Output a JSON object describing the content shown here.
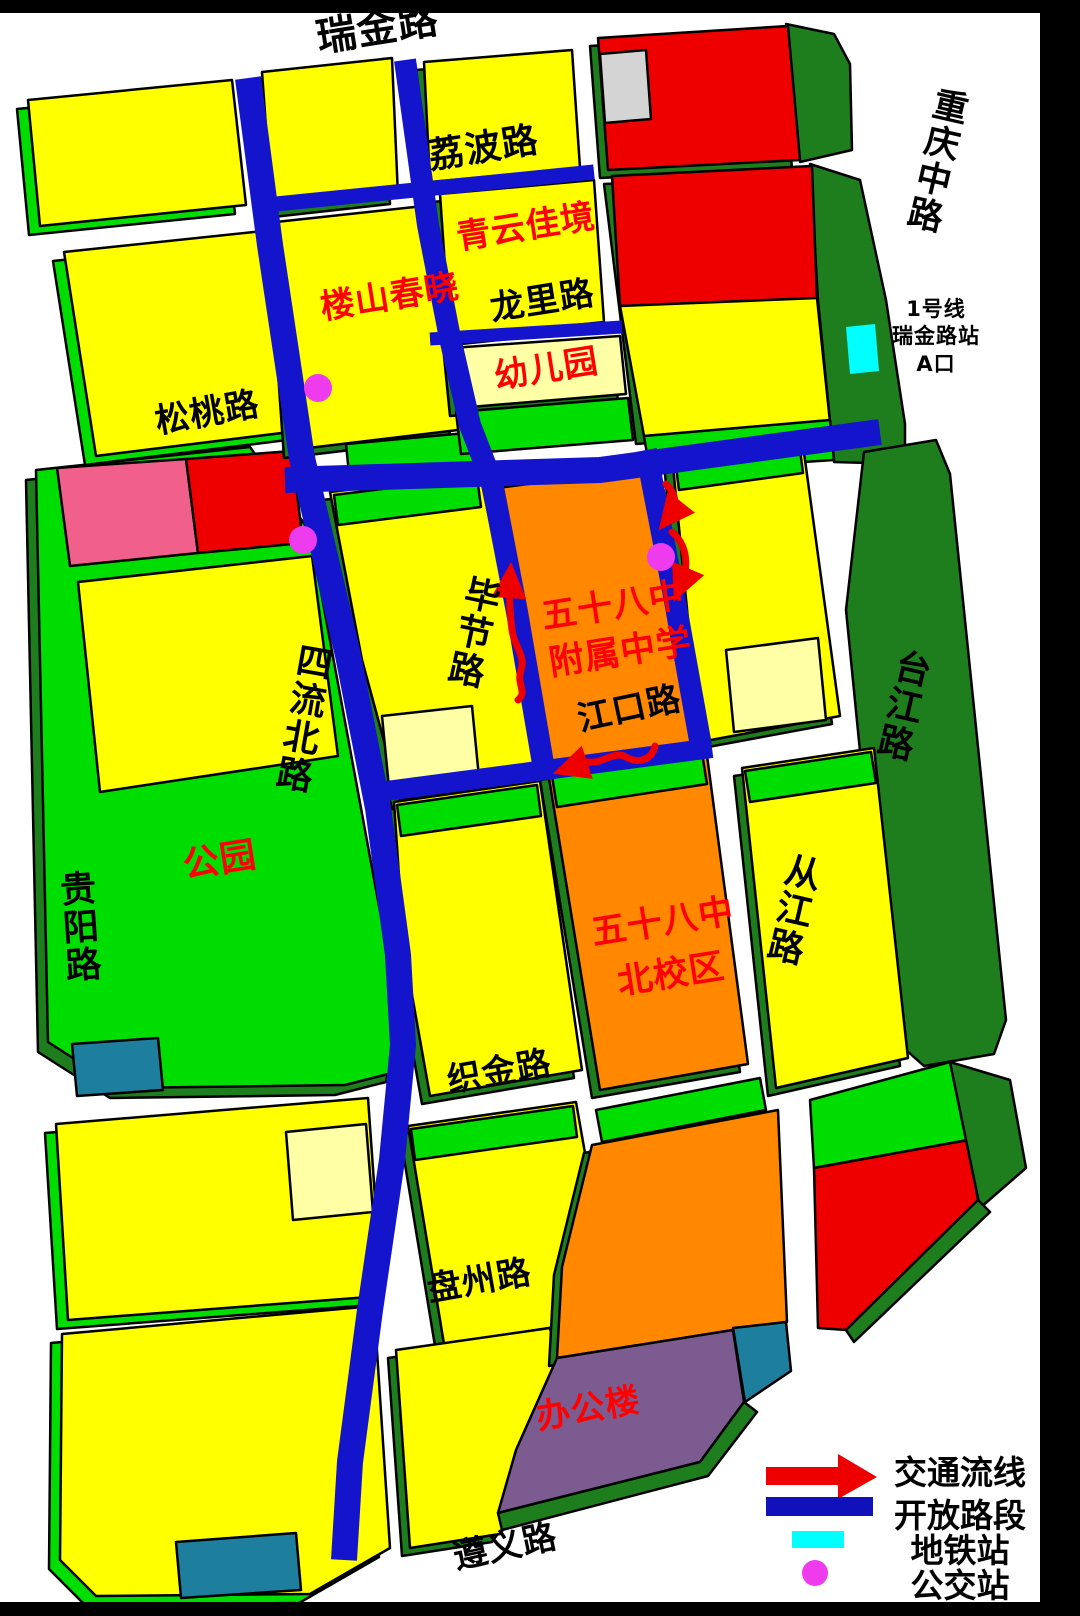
{
  "map": {
    "road_labels": {
      "ruijin": "瑞金路",
      "libo": "荔波路",
      "chongqing_zhong": "重庆中路",
      "longli": "龙里路",
      "songtao": "松桃路",
      "bijie": "毕节路",
      "siliu_north": "四流北路",
      "jiangkou": "江口路",
      "guiyang": "贵阳路",
      "taijiang": "台江路",
      "congjiang": "从江路",
      "zhijin": "织金路",
      "panzhou": "盘州路",
      "zunyi": "遵义路"
    },
    "place_labels": {
      "qingyun": "青云佳境",
      "loushan": "楼山春晓",
      "kindergarten": "幼儿园",
      "school_affiliated_line1": "五十八中",
      "school_affiliated_line2": "附属中学",
      "school_north_line1": "五十八中",
      "school_north_line2": "北校区",
      "park": "公园",
      "office": "办公楼"
    },
    "metro_station": {
      "line1": "1号线",
      "line2": "瑞金路站",
      "line3": "A口"
    }
  },
  "legend": {
    "items": [
      {
        "key": "traffic-flow",
        "label": "交通流线"
      },
      {
        "key": "open-road",
        "label": "开放路段"
      },
      {
        "key": "metro-station",
        "label": "地铁站"
      },
      {
        "key": "bus-station",
        "label": "公交站"
      }
    ]
  },
  "colors": {
    "road_blue": "#1414CC",
    "legend_blue": "#1111BB",
    "block_yellow": "#FFFF00",
    "block_cream": "#FFFFA6",
    "green_bright": "#00DD00",
    "green_dark": "#1E7E1E",
    "orange": "#FF8800",
    "red": "#EE0000",
    "pink": "#F0608A",
    "purple": "#7C5C90",
    "teal": "#1E7E9E",
    "gray": "#D4D4D4",
    "cyan": "#00FFFF",
    "magenta": "#EE3BEE",
    "label_red": "#FF0000"
  }
}
